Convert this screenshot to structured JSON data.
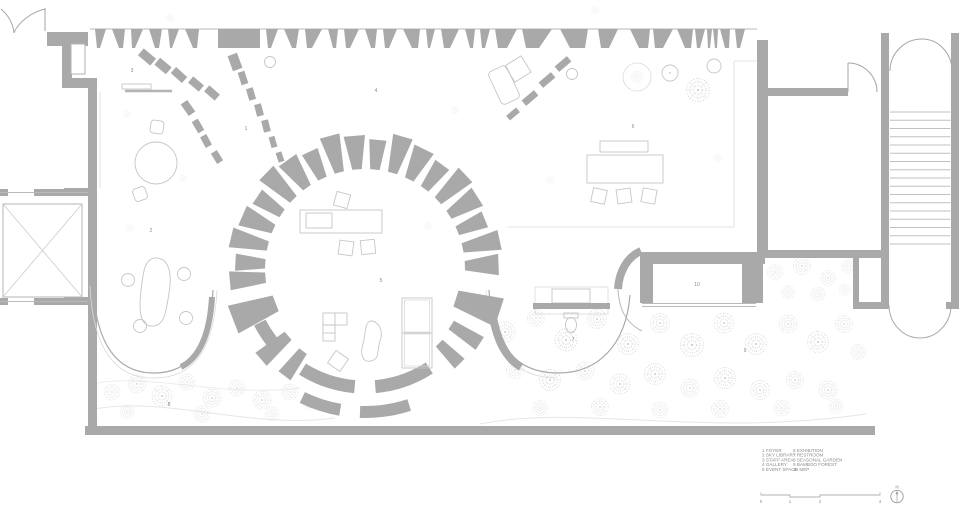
{
  "plan": {
    "rooms": [
      {
        "num": "1",
        "label": "1 FOYER"
      },
      {
        "num": "2",
        "label": "2 SKY LIBRARY"
      },
      {
        "num": "3",
        "label": "3 STAFF AREA"
      },
      {
        "num": "4",
        "label": "4 GALLERY"
      },
      {
        "num": "5",
        "label": "5 EVENT SPACE"
      },
      {
        "num": "6",
        "label": "6 EXHIBITION"
      },
      {
        "num": "7",
        "label": "7 RESTROOM"
      },
      {
        "num": "8",
        "label": "8 SEASONAL GARDEN"
      },
      {
        "num": "9",
        "label": "9 BAMBOO FOREST"
      },
      {
        "num": "10",
        "label": "10 MEP"
      }
    ]
  },
  "scale_bar": {
    "ticks": [
      "0",
      "1",
      "2",
      "4"
    ]
  },
  "north_arrow": {
    "label": "N"
  },
  "colors": {
    "wall": "#a9a9a9",
    "furniture_line": "#c6c6c6",
    "garden_line": "#d5d5d5",
    "text": "#8a8a8a"
  }
}
